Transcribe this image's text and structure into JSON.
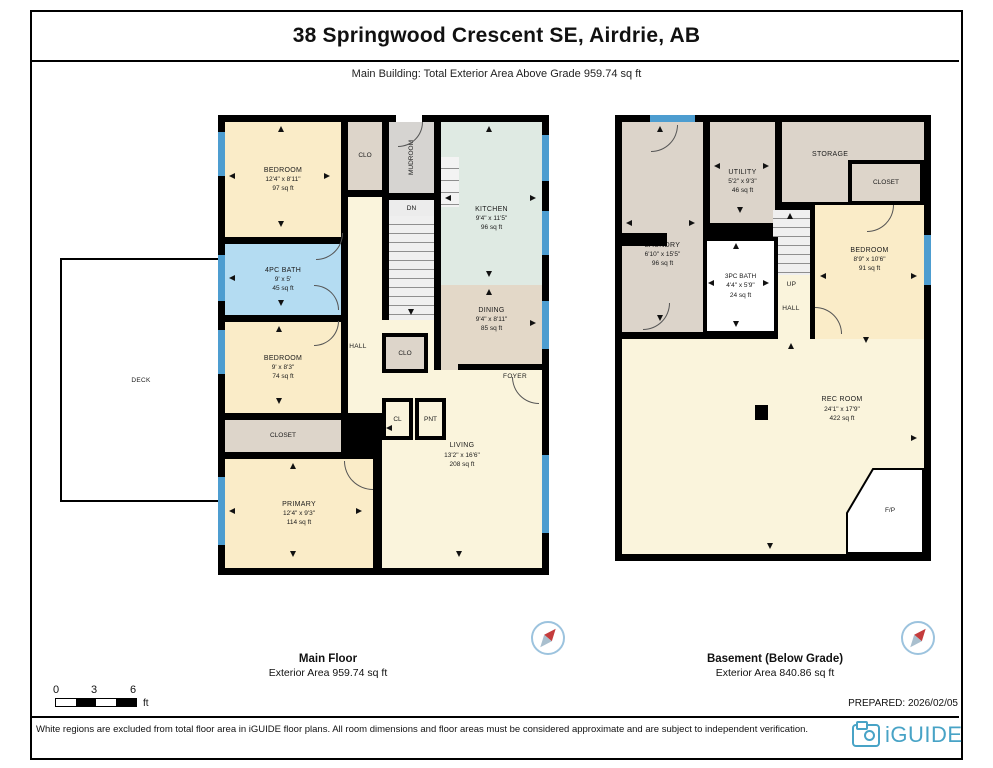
{
  "page": {
    "title": "38 Springwood Crescent SE, Airdrie, AB",
    "subtitle": "Main Building: Total Exterior Area Above Grade 959.74 sq ft",
    "prepared": "PREPARED: 2026/02/05",
    "disclaimer": "White regions are excluded from total floor area in iGUIDE floor plans. All room dimensions and floor areas must be considered approximate and are subject to independent verification.",
    "brand": "iGUIDE"
  },
  "scale_bar": {
    "t0": "0",
    "t1": "3",
    "t2": "6",
    "unit": "ft"
  },
  "colors": {
    "wall": "#000000",
    "window_marker": "#4d9dd0",
    "bedroom_yellow": "#faecc8",
    "living_cream": "#faf4dc",
    "dining_tan": "#e3d8c8",
    "kitchen_sage": "#dfeae3",
    "bath_blue": "#b4dcf2",
    "closet_beige": "#ddd5ca",
    "mudroom_gray": "#d6d4d1",
    "brand_teal": "#48a3c6"
  },
  "floors": [
    {
      "caption": "Main Floor",
      "area_caption": "Exterior Area 959.74 sq ft",
      "rooms": {
        "bedroom1": {
          "name": "BEDROOM",
          "dims": "12'4\" x 8'11\"",
          "area": "97 sq ft"
        },
        "clo_top": {
          "name": "CLO"
        },
        "mudroom": {
          "name": "MUDROOM"
        },
        "stairs_dn": {
          "name": "DN"
        },
        "kitchen": {
          "name": "KITCHEN",
          "dims": "9'4\" x 11'5\"",
          "area": "96 sq ft"
        },
        "bath_4pc": {
          "name": "4PC BATH",
          "dims": "9' x 5'",
          "area": "45 sq ft"
        },
        "dining": {
          "name": "DINING",
          "dims": "9'4\" x 8'11\"",
          "area": "85 sq ft"
        },
        "bedroom2": {
          "name": "BEDROOM",
          "dims": "9' x 8'3\"",
          "area": "74 sq ft"
        },
        "hall": {
          "name": "HALL"
        },
        "clo_hall": {
          "name": "CLO"
        },
        "cl": {
          "name": "CL"
        },
        "pnt": {
          "name": "PNT"
        },
        "foyer": {
          "name": "FOYER"
        },
        "closet": {
          "name": "CLOSET"
        },
        "primary": {
          "name": "PRIMARY",
          "dims": "12'4\" x 9'3\"",
          "area": "114 sq ft"
        },
        "living": {
          "name": "LIVING",
          "dims": "13'2\" x 16'6\"",
          "area": "208 sq ft"
        },
        "deck": {
          "name": "DECK"
        }
      }
    },
    {
      "caption": "Basement (Below Grade)",
      "area_caption": "Exterior Area 840.86 sq ft",
      "rooms": {
        "laundry": {
          "name": "LAUNDRY",
          "dims": "6'10\" x 15'5\"",
          "area": "96 sq ft"
        },
        "utility": {
          "name": "UTILITY",
          "dims": "5'2\" x 9'3\"",
          "area": "46 sq ft"
        },
        "storage": {
          "name": "STORAGE"
        },
        "closet": {
          "name": "CLOSET"
        },
        "bedroom": {
          "name": "BEDROOM",
          "dims": "8'9\" x 10'6\"",
          "area": "91 sq ft"
        },
        "bath_3pc": {
          "name": "3PC BATH",
          "dims": "4'4\" x 5'9\"",
          "area": "24 sq ft"
        },
        "stairs_up": {
          "name": "UP"
        },
        "hall": {
          "name": "HALL"
        },
        "rec_room": {
          "name": "REC ROOM",
          "dims": "24'1\" x 17'9\"",
          "area": "422 sq ft"
        },
        "fireplace": {
          "name": "F/P"
        }
      }
    }
  ]
}
